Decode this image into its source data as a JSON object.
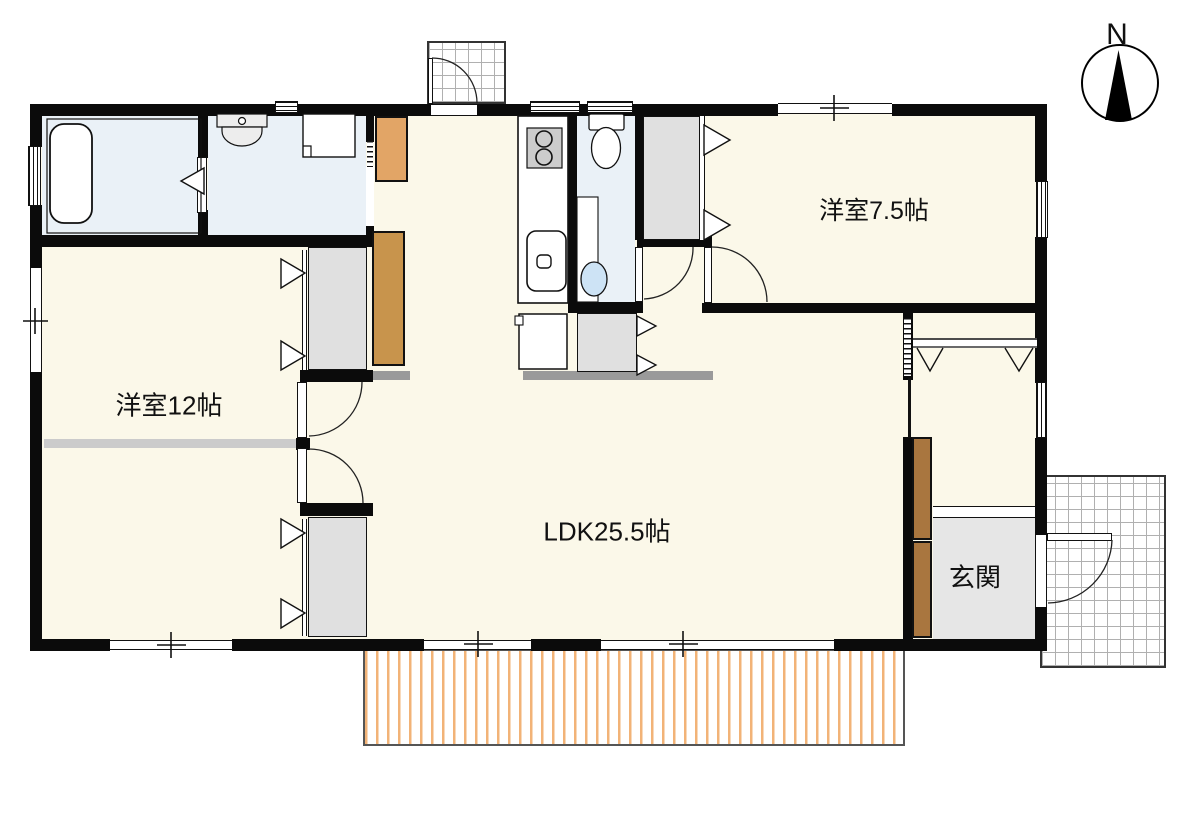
{
  "compass": {
    "north_label": "N"
  },
  "rooms": {
    "western_room_12": {
      "label": "洋室12帖"
    },
    "western_room_7_5": {
      "label": "洋室7.5帖"
    },
    "ldk": {
      "label": "LDK25.5帖"
    },
    "entrance": {
      "label": "玄関"
    }
  },
  "colors": {
    "floor_cream": "#FBF8E9",
    "wet_blue": "#EAF1F7",
    "closet_gray": "#E0E0E0",
    "genkan_gray": "#E6E6E6",
    "wall_black": "#0B0B0B",
    "cab_orange": "#E2A566",
    "cab_tan": "#C8944C",
    "cab_brown": "#A9763F",
    "deck_stripe": "#F2B377",
    "divider_gray": "#9A9A9A",
    "divider_light": "#CBCBCB",
    "basin_blue": "#CDE3F5"
  }
}
